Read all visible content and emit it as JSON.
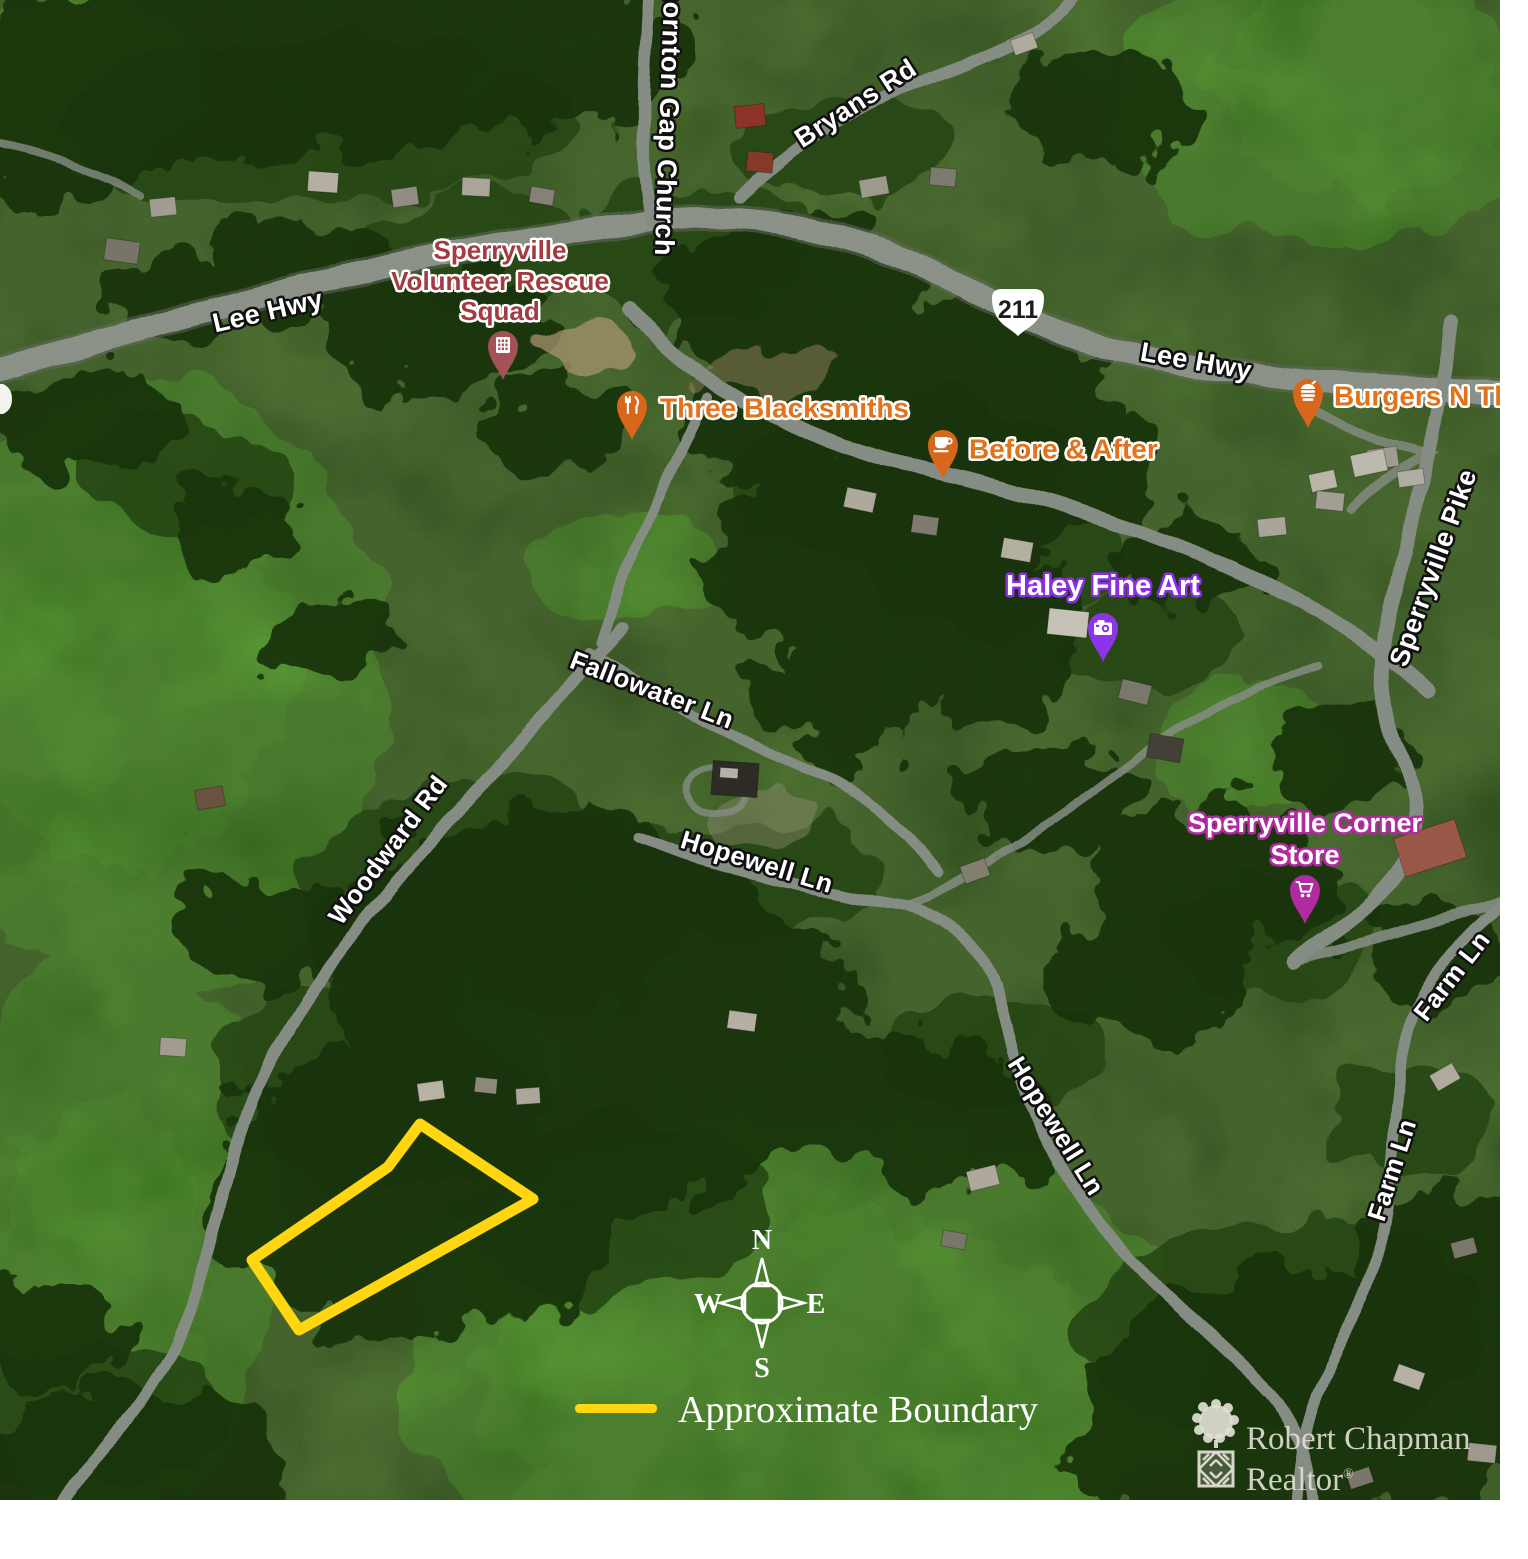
{
  "page": {
    "background": "#ffffff",
    "map_width": 1500,
    "map_height": 1500
  },
  "colors": {
    "boundary_yellow": "#ffd60f",
    "road_label_text": "#ffffff",
    "poi_orange": "#e2731a",
    "poi_maroon_text": "#a33c42",
    "poi_maroon_pin": "#a35257",
    "poi_purple_pin": "#8b34e8",
    "poi_magenta_pin": "#b12aa2",
    "shield_fill": "#ffffff",
    "legend_text": "#ffffff"
  },
  "map": {
    "road_labels": [
      {
        "text": "Lee Hwy",
        "x": 268,
        "y": 312,
        "rotate": -13,
        "size": 27
      },
      {
        "text": "Thornton Gap Church",
        "x": 668,
        "y": 112,
        "rotate": 92,
        "size": 27
      },
      {
        "text": "Bryans Rd",
        "x": 856,
        "y": 104,
        "rotate": -33,
        "size": 27
      },
      {
        "text": "Lee Hwy",
        "x": 1196,
        "y": 362,
        "rotate": 10,
        "size": 27
      },
      {
        "text": "Sperryville Pike",
        "x": 1434,
        "y": 568,
        "rotate": -70,
        "size": 27
      },
      {
        "text": "Fallowater Ln",
        "x": 652,
        "y": 690,
        "rotate": 21,
        "size": 26
      },
      {
        "text": "Woodward Rd",
        "x": 388,
        "y": 850,
        "rotate": -53,
        "size": 26
      },
      {
        "text": "Hopewell Ln",
        "x": 757,
        "y": 862,
        "rotate": 17,
        "size": 26
      },
      {
        "text": "Hopewell Ln",
        "x": 1056,
        "y": 1126,
        "rotate": 58,
        "size": 26
      },
      {
        "text": "Farm Ln",
        "x": 1452,
        "y": 976,
        "rotate": -52,
        "size": 26
      },
      {
        "text": "Farm Ln",
        "x": 1392,
        "y": 1170,
        "rotate": -72,
        "size": 26
      }
    ],
    "route_shield": {
      "label": "211",
      "x": 1018,
      "y": 312
    },
    "pois": [
      {
        "name": "sperryville-volunteer-rescue-squad",
        "label": "Sperryville\nVolunteer Rescue\nSquad",
        "style": "maroon",
        "pin_color": "#a35257",
        "icon": "building-icon",
        "pin_x": 503,
        "pin_y": 346,
        "label_x": 500,
        "label_y": 281,
        "label_align": "center"
      },
      {
        "name": "three-blacksmiths",
        "label": "Three Blacksmiths",
        "style": "orange",
        "pin_color": "#d9671b",
        "icon": "restaurant-icon",
        "pin_x": 632,
        "pin_y": 406,
        "label_x": 660,
        "label_y": 408,
        "label_align": "left"
      },
      {
        "name": "before-and-after",
        "label": "Before & After",
        "style": "orange",
        "pin_color": "#d9671b",
        "icon": "cafe-icon",
        "pin_x": 943,
        "pin_y": 445,
        "label_x": 969,
        "label_y": 449,
        "label_align": "left"
      },
      {
        "name": "burgers-n-things",
        "label": "Burgers N Things",
        "style": "orange",
        "pin_color": "#d9671b",
        "icon": "fastfood-icon",
        "pin_x": 1308,
        "pin_y": 394,
        "label_x": 1334,
        "label_y": 396,
        "label_align": "left"
      },
      {
        "name": "haley-fine-art",
        "label": "Haley Fine Art",
        "style": "white-purple",
        "pin_color": "#8b34e8",
        "icon": "camera-icon",
        "pin_x": 1103,
        "pin_y": 628,
        "label_x": 1103,
        "label_y": 586,
        "label_align": "center"
      },
      {
        "name": "sperryville-corner-store",
        "label": "Sperryville Corner\nStore",
        "style": "white-magenta",
        "pin_color": "#b12aa2",
        "icon": "cart-icon",
        "pin_x": 1305,
        "pin_y": 890,
        "label_x": 1305,
        "label_y": 840,
        "label_align": "center"
      }
    ],
    "boundary": {
      "points": [
        [
          420,
          1124
        ],
        [
          533,
          1199
        ],
        [
          299,
          1330
        ],
        [
          252,
          1260
        ],
        [
          388,
          1167
        ]
      ],
      "color": "#ffd60f",
      "stroke_width": 11
    },
    "compass": {
      "n": "N",
      "e": "E",
      "s": "S",
      "w": "W",
      "x": 762,
      "y": 1303
    },
    "legend": {
      "label": "Approximate Boundary"
    },
    "logo": {
      "line1": "Robert Chapman",
      "line2": "Realtor",
      "reg": "®"
    }
  }
}
